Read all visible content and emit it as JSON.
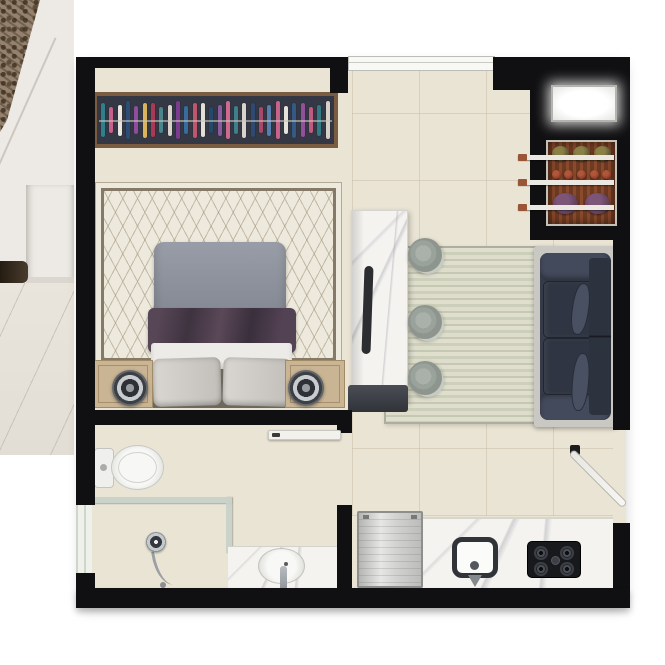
{
  "scene": {
    "description": "Top-down 3D rendered floor plan of a studio apartment, overlapping an interior photograph strip along the left edge",
    "text_labels": []
  },
  "palette": {
    "wall": "#101012",
    "floor": "#eae4d4",
    "photo-wall": "#edeae5",
    "textile": "#94826e",
    "wood-frame": "#7a5d41",
    "wardrobe-interior": "#343844",
    "rug-bedroom": "#ede9dc",
    "rug-border": "#857a68",
    "duvet": "#8e929c",
    "blanket": "#493a45",
    "sheet": "#edebe7",
    "pillow": "#d3d0cd",
    "nightstand": "#c9b494",
    "marble": "#f4f3f0",
    "island-cap": "#41444c",
    "stool": "#9aa29c",
    "rug-living-a": "#dedcca",
    "rug-living-b": "#ccd0ba",
    "sofa-platform": "#c9c8c3",
    "sofa-body": "#353b49",
    "sofa-cushion": "#2f3542",
    "sofa-pillow": "#495061",
    "rack-wood": "#713c24",
    "shelf-bar": "#ebe8e1",
    "shelf-bar-tip": "#9a5436",
    "door-leaf": "#f2f1ec",
    "glass": "#ccd6ce",
    "porcelain": "#f4f4f1",
    "steel": "#c7c9c9",
    "hob": "#17191d",
    "white-panel": "#ffffff"
  },
  "rooms": [
    {
      "name": "bedroom",
      "furniture": [
        "wardrobe with hanging clothes",
        "trellis area rug",
        "double bed with gray duvet, plum blanket and two pillows",
        "two nightstands with round table lamps"
      ]
    },
    {
      "name": "living-dining",
      "furniture": [
        "marble island counter with handle",
        "three round bar stools",
        "striped area rug",
        "dark two-seat sofa with lozenge pillows"
      ]
    },
    {
      "name": "entry",
      "furniture": [
        "glowing white panel",
        "wooden shoe rack with three shelves",
        "open entry door"
      ]
    },
    {
      "name": "bathroom",
      "furniture": [
        "toilet",
        "glass shower enclosure with hand shower",
        "marble vanity with oval basin",
        "open bathroom door"
      ]
    },
    {
      "name": "kitchen",
      "furniture": [
        "stainless refrigerator",
        "marble counter",
        "square sink with faucet",
        "four-burner gas cooktop"
      ]
    }
  ],
  "bedroom": {
    "wardrobe": {
      "clothes_colors": [
        "#2f7f8c",
        "#c8608c",
        "#e9e5df",
        "#2b4d75",
        "#8e4d9e",
        "#d9b45c",
        "#a93a56",
        "#49858c",
        "#d7d3cb",
        "#7b3b8e",
        "#396c9e",
        "#c2556e",
        "#e3ded6",
        "#25486e",
        "#8c5aa0",
        "#cf6a8e",
        "#3d7f8a",
        "#d8d4cc",
        "#2e4a72",
        "#a8486a",
        "#577fae",
        "#c9628a",
        "#e6e2da",
        "#335a84",
        "#90509a",
        "#c05a7e",
        "#2f7a86",
        "#d5d1c9"
      ]
    }
  },
  "living": {
    "stools": {
      "count": 3
    }
  },
  "entry": {
    "shoe_rack": {
      "shelf_bar_count": 3,
      "rows": [
        {
          "color": "#55512f",
          "highlight": "#8a7f46",
          "count": 3
        },
        {
          "color": "#8c3524",
          "highlight": "#b0573a",
          "count": 5
        },
        {
          "color": "#5b3b57",
          "highlight": "#7c5578",
          "count": 2
        }
      ]
    }
  },
  "kitchen": {
    "cooktop": {
      "burner_count": 4
    }
  }
}
